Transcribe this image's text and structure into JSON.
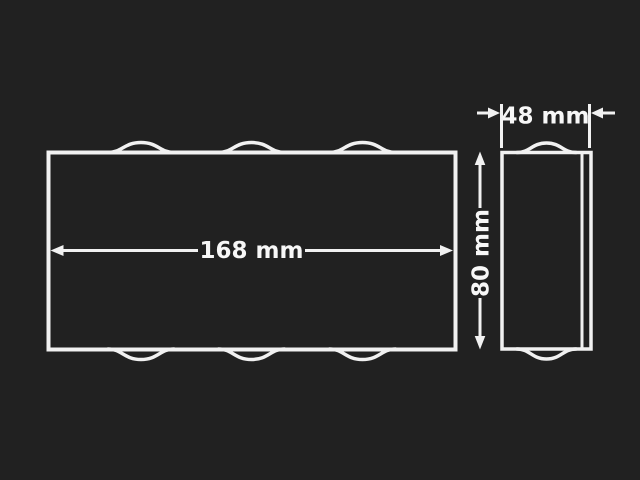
{
  "colors": {
    "background": "#212121",
    "line": "#f1f1f1",
    "text": "#f7f7f7"
  },
  "front_view": {
    "width_dimension_label": "168 mm",
    "width_mm": 168
  },
  "side_view": {
    "depth_dimension_label": "48 mm",
    "depth_mm": 48,
    "height_dimension_label": "80 mm",
    "height_mm": 80
  }
}
